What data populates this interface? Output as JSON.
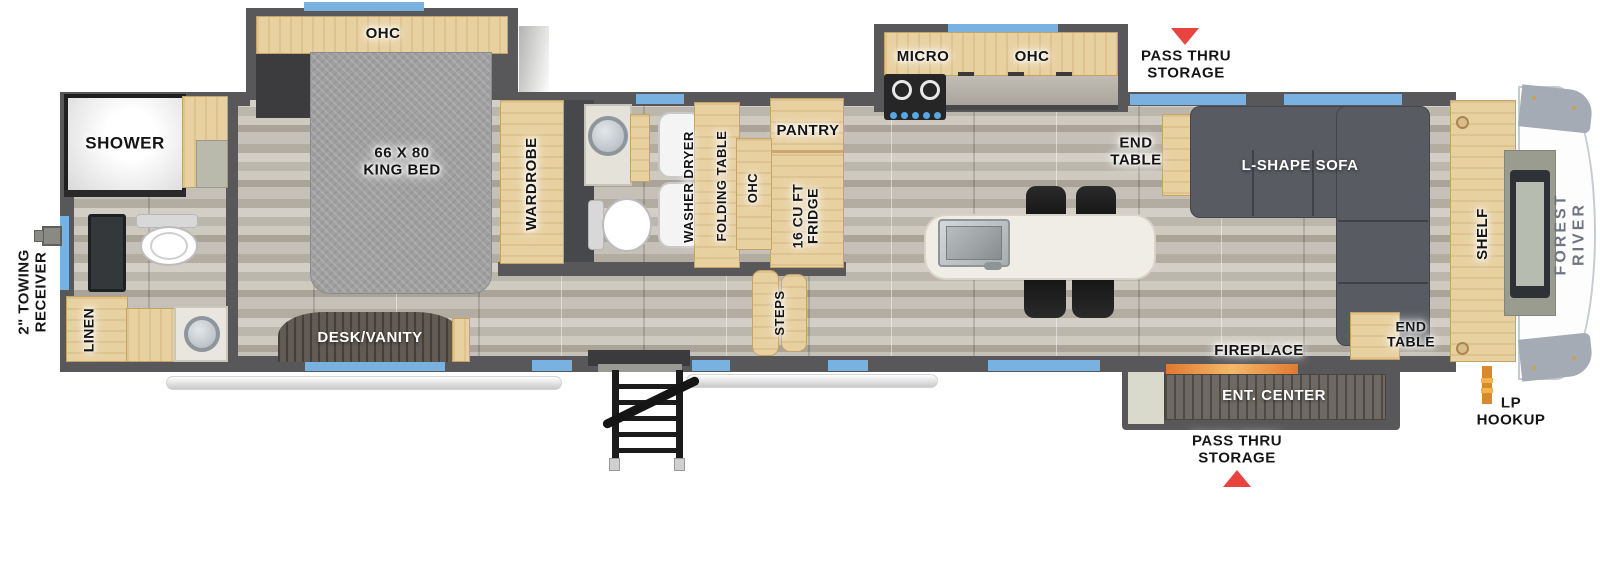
{
  "colors": {
    "accent_blue": "#79b2e0",
    "arrow_red": "#e8433e",
    "wood_tan": "#e8d1a1",
    "wall_gray": "#58585a",
    "floor_gray": "#c6c1b8",
    "sofa_gray": "#585b62",
    "brand_text_gray": "#6e7580",
    "fireplace_glow_orange": "#e07830",
    "lp_pipe_orange": "#d9882a"
  },
  "exterior": {
    "towing_receiver": "2\" TOWING\nRECEIVER",
    "pass_thru_top": "PASS THRU\nSTORAGE",
    "pass_thru_bottom": "PASS THRU\nSTORAGE",
    "lp_hookup": "LP\nHOOKUP",
    "brand": "FOREST RIVER"
  },
  "bedroom": {
    "ohc": "OHC",
    "bed": "66 X 80\nKING BED",
    "wardrobe": "WARDROBE",
    "desk_vanity": "DESK/VANITY"
  },
  "bathroom": {
    "shower": "SHOWER",
    "linen": "LINEN"
  },
  "laundry": {
    "washer_dryer": "WASHER DRYER",
    "folding_table": "FOLDING TABLE",
    "ohc": "OHC"
  },
  "kitchen": {
    "pantry": "PANTRY",
    "fridge": "16 CU FT\nFRIDGE",
    "steps": "STEPS",
    "micro": "MICRO",
    "ohc": "OHC"
  },
  "living": {
    "end_table_top": "END\nTABLE",
    "sofa": "L-SHAPE SOFA",
    "shelf": "SHELF",
    "end_table_bottom": "END\nTABLE",
    "fireplace": "FIREPLACE",
    "ent_center": "ENT. CENTER"
  }
}
